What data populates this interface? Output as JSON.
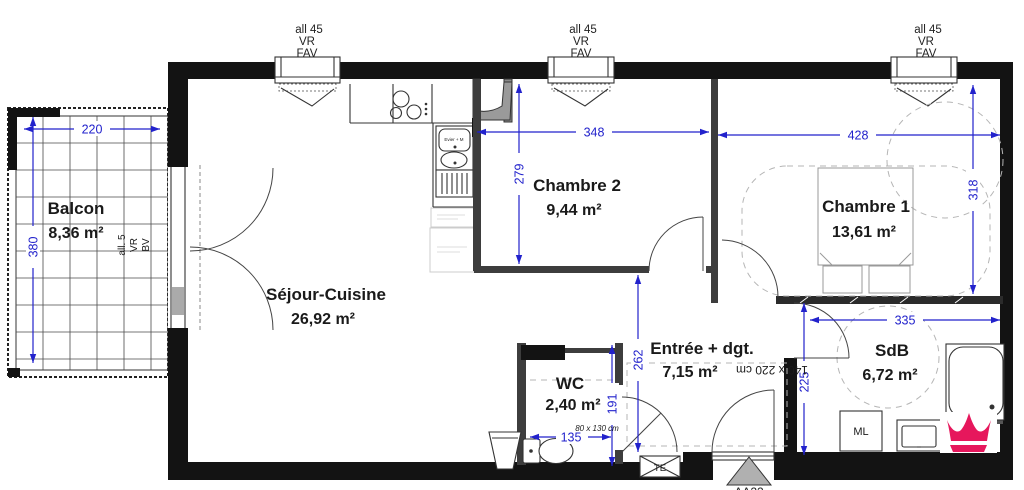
{
  "windows": {
    "label_top": "all 45",
    "label_mid": "VR",
    "label_bot": "FAV"
  },
  "balcony_door_label": {
    "l1": "all. 5",
    "l2": "VR",
    "l3": "BV"
  },
  "rooms": {
    "balcon": {
      "name": "Balcon",
      "area": "8,36 m²"
    },
    "sejour": {
      "name": "Séjour-Cuisine",
      "area": "26,92 m²"
    },
    "chambre2": {
      "name": "Chambre 2",
      "area": "9,44 m²"
    },
    "chambre1": {
      "name": "Chambre 1",
      "area": "13,61 m²"
    },
    "entree": {
      "name": "Entrée + dgt.",
      "area": "7,15 m²"
    },
    "wc": {
      "name": "WC",
      "area": "2,40 m²"
    },
    "sdb": {
      "name": "SdB",
      "area": "6,72 m²"
    }
  },
  "dimensions": {
    "balcon_w": "220",
    "balcon_h": "380",
    "chambre2_w": "348",
    "chambre2_h": "279",
    "chambre1_w": "428",
    "chambre1_h": "318",
    "sdb_w": "335",
    "sdb_h": "225",
    "entree_h": "262",
    "wc_h": "191",
    "wc_w": "135"
  },
  "annotations": {
    "wc_door_size": "80 x 130 cm",
    "bed_size": "140 x 220 cm",
    "sink_label": "Evier + M",
    "electrical_panel": "TE",
    "washing_machine": "ML",
    "section_marker": "AA22"
  },
  "colors": {
    "dimension_blue": "#2222cc",
    "wall_black": "#131313",
    "logo_pink": "#e6175c"
  }
}
